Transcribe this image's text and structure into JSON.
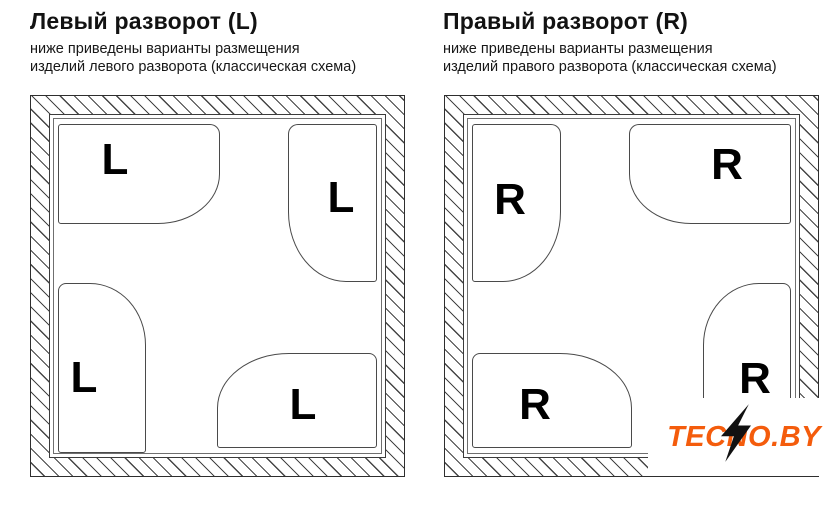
{
  "page": {
    "background": "#ffffff"
  },
  "panels": [
    {
      "title": "Левый разворот (L)",
      "subtitle_line1": "ниже приведены варианты размещения",
      "subtitle_line2": "изделий левого разворота (классическая схема)",
      "letter": "L"
    },
    {
      "title": "Правый разворот (R)",
      "subtitle_line1": "ниже приведены варианты размещения",
      "subtitle_line2": "изделий правого разворота (классическая схема)",
      "letter": "R"
    }
  ],
  "watermark": {
    "brand_pre": "TEC",
    "brand_n": "N",
    "brand_post": "O.BY",
    "brand_full": "TECNO.BY",
    "brand_color": "#f45c0c",
    "bolt_color": "#111111"
  },
  "colors": {
    "wall_line": "#3c3c3c",
    "bath_line": "#4a4a4a",
    "text": "#121212"
  }
}
